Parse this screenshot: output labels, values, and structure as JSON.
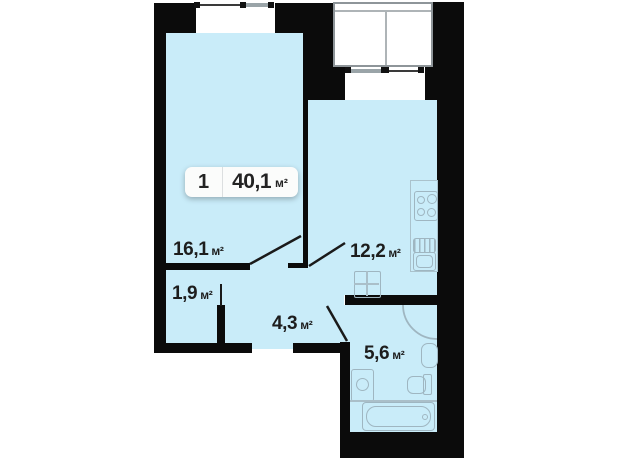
{
  "plan": {
    "type": "apartment-floor-plan",
    "badge": {
      "rooms": "1",
      "area": "40,1",
      "unit": "м²"
    },
    "rooms": [
      {
        "id": "living-room",
        "area": "16,1",
        "unit": "м²"
      },
      {
        "id": "kitchen",
        "area": "12,2",
        "unit": "м²"
      },
      {
        "id": "closet",
        "area": "1,9",
        "unit": "м²"
      },
      {
        "id": "hallway",
        "area": "4,3",
        "unit": "м²"
      },
      {
        "id": "bathroom",
        "area": "5,6",
        "unit": "м²"
      }
    ],
    "icons": [
      "stove-icon",
      "kitchen-sink-icon",
      "dining-table-icon",
      "shower-icon",
      "basin-icon",
      "toilet-icon",
      "washing-machine-icon",
      "bathtub-icon",
      "window-icon",
      "balcony",
      "door-swing"
    ],
    "colors": {
      "room_fill": "#c9ecf9",
      "wall": "#0b0b0b",
      "fixture": "#9fb6c1",
      "background": "#ffffff"
    }
  }
}
